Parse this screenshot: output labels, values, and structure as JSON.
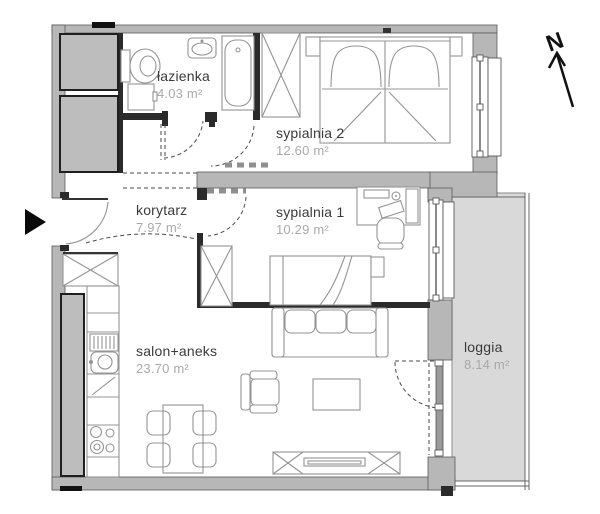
{
  "title": "apartment-floor-plan",
  "rooms": [
    {
      "name": "łazienka",
      "area": "4.03 m²"
    },
    {
      "name": "sypialnia 2",
      "area": "12.60 m²"
    },
    {
      "name": "korytarz",
      "area": "7.97 m²"
    },
    {
      "name": "sypialnia 1",
      "area": "10.29 m²"
    },
    {
      "name": "salon+aneks",
      "area": "23.70 m²"
    },
    {
      "name": "loggia",
      "area": "8.14 m²"
    }
  ],
  "compass": {
    "label": "N"
  },
  "colors": {
    "wall": "#b7b7b7",
    "interior_wall": "#2b2b2b",
    "loggia_floor": "#d9d9d9",
    "furniture_line": "#949494",
    "room_name_text": "#3a3a3a",
    "room_area_text": "#a9a9a9",
    "background": "#ffffff"
  }
}
